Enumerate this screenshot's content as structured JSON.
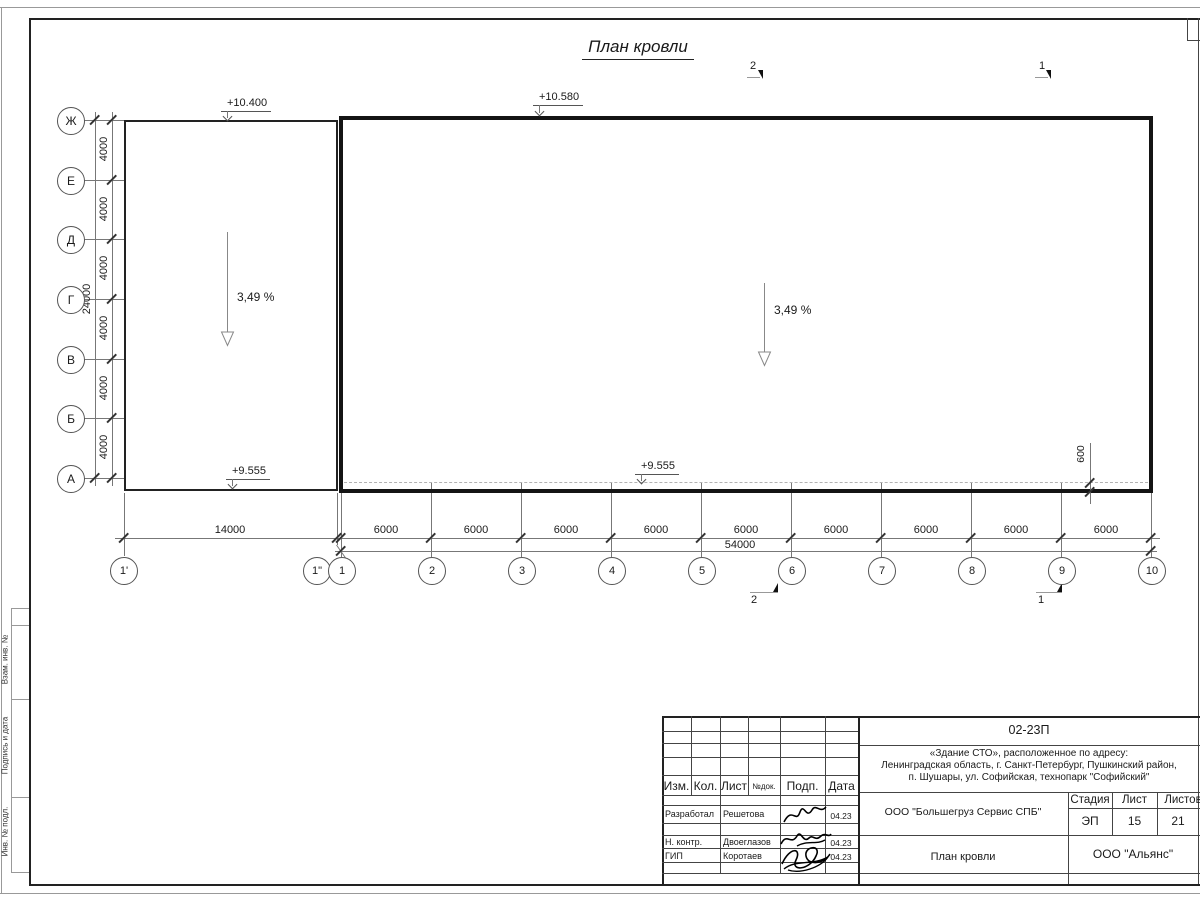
{
  "sheet": {
    "title": "План кровли",
    "margin_labels": [
      "Взам. инв. №",
      "Подпись и дата",
      "Инв. № подл."
    ]
  },
  "drawing": {
    "elevations": {
      "top_left": "+10.400",
      "top_mid": "+10.580",
      "bottom_left": "+9.555",
      "bottom_mid": "+9.555"
    },
    "slopes": {
      "left": "3,49 %",
      "right": "3,49 %"
    },
    "sections": {
      "top": [
        "2",
        "1"
      ],
      "bottom": [
        "2",
        "1"
      ]
    },
    "axes": {
      "rows": [
        "Ж",
        "Е",
        "Д",
        "Г",
        "В",
        "Б",
        "А"
      ],
      "cols": [
        "1'",
        "1\"",
        "1",
        "2",
        "3",
        "4",
        "5",
        "6",
        "7",
        "8",
        "9",
        "10"
      ]
    },
    "dims": {
      "row_total": "24000",
      "row_segments": [
        "4000",
        "4000",
        "4000",
        "4000",
        "4000",
        "4000"
      ],
      "col_first": "14000",
      "col_segments": [
        "6000",
        "6000",
        "6000",
        "6000",
        "6000",
        "6000",
        "6000",
        "6000",
        "6000"
      ],
      "col_total": "54000",
      "roof_overhang": "600"
    }
  },
  "title_block": {
    "doc_number": "02-23П",
    "address_lines": [
      "«Здание СТО», расположенное по адресу:",
      "Ленинградская область, г. Санкт-Петербург, Пушкинский район,",
      "п. Шушары, ул. Софийская, технопарк \"Софийский\""
    ],
    "header_cols": [
      "Изм.",
      "Кол.",
      "Лист",
      "№док.",
      "Подп.",
      "Дата"
    ],
    "rows": [
      {
        "role": "Разработал",
        "name": "Решетова",
        "date": "04.23"
      },
      {
        "role": "Н. контр.",
        "name": "Двоеглазов",
        "date": "04.23"
      },
      {
        "role": "ГИП",
        "name": "Коротаев",
        "date": "04.23"
      }
    ],
    "company": "ООО \"Большегруз Сервис СПБ\"",
    "stage_label": "Стадия",
    "sheet_label": "Лист",
    "sheets_label": "Листов",
    "stage": "ЭП",
    "sheet_num": "15",
    "sheets_total": "21",
    "drawing_name": "План кровли",
    "contractor": "ООО \"Альянс\""
  }
}
